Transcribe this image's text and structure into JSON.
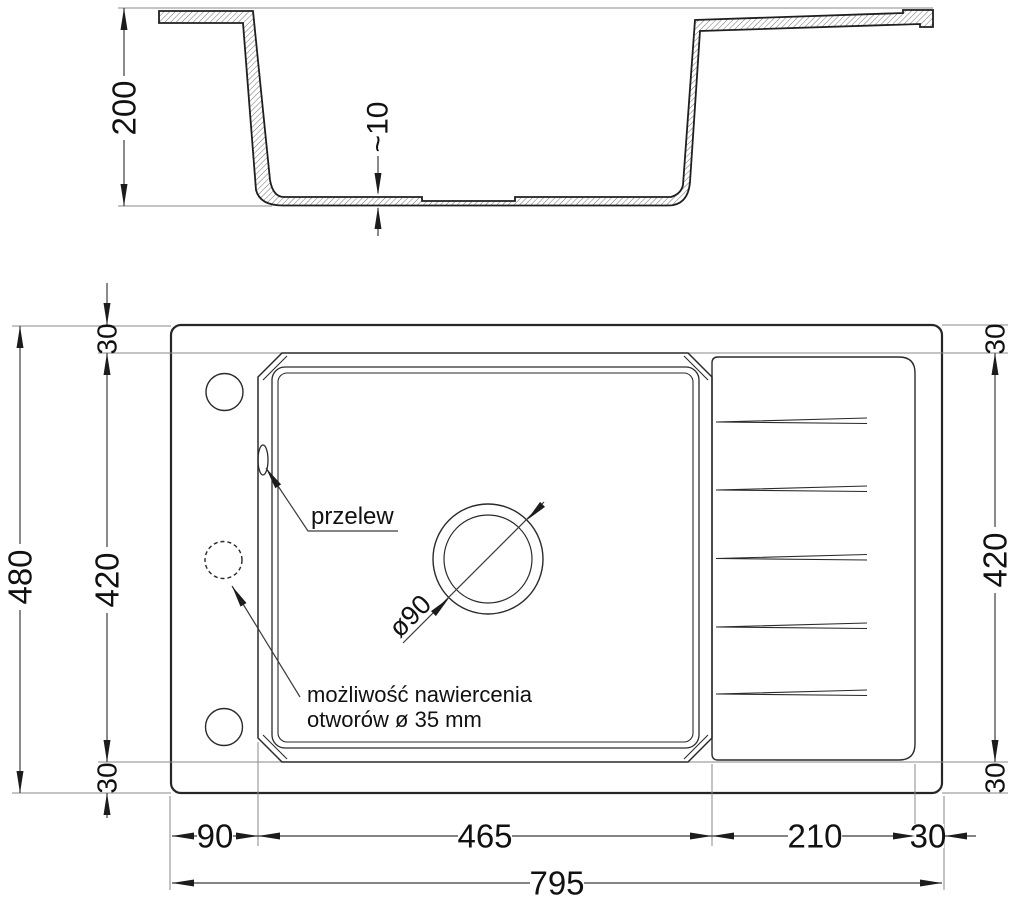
{
  "drawing_title": "sink-technical-drawing",
  "section": {
    "height_label": "200",
    "bottom_thickness_label": "~10"
  },
  "plan": {
    "overall_width": "795",
    "overall_height": "480",
    "left_offset": "90",
    "bowl_width": "465",
    "drainboard_width": "210",
    "right_offset": "30",
    "inner_height_left": "420",
    "inner_height_right": "420",
    "margin_top_left": "30",
    "margin_bottom_left": "30",
    "margin_top_right": "30",
    "margin_bottom_right": "30",
    "drain_diameter_label": "ø90",
    "overflow_label": "przelew",
    "drill_note_line1": "możliwość nawiercenia",
    "drill_note_line2": "otworów ø 35 mm"
  },
  "colors": {
    "background": "#ffffff",
    "part_line": "#2a2a2a",
    "dimension_line": "#3c3c3c",
    "extension_line": "#8a8a8a",
    "text": "#111111"
  }
}
